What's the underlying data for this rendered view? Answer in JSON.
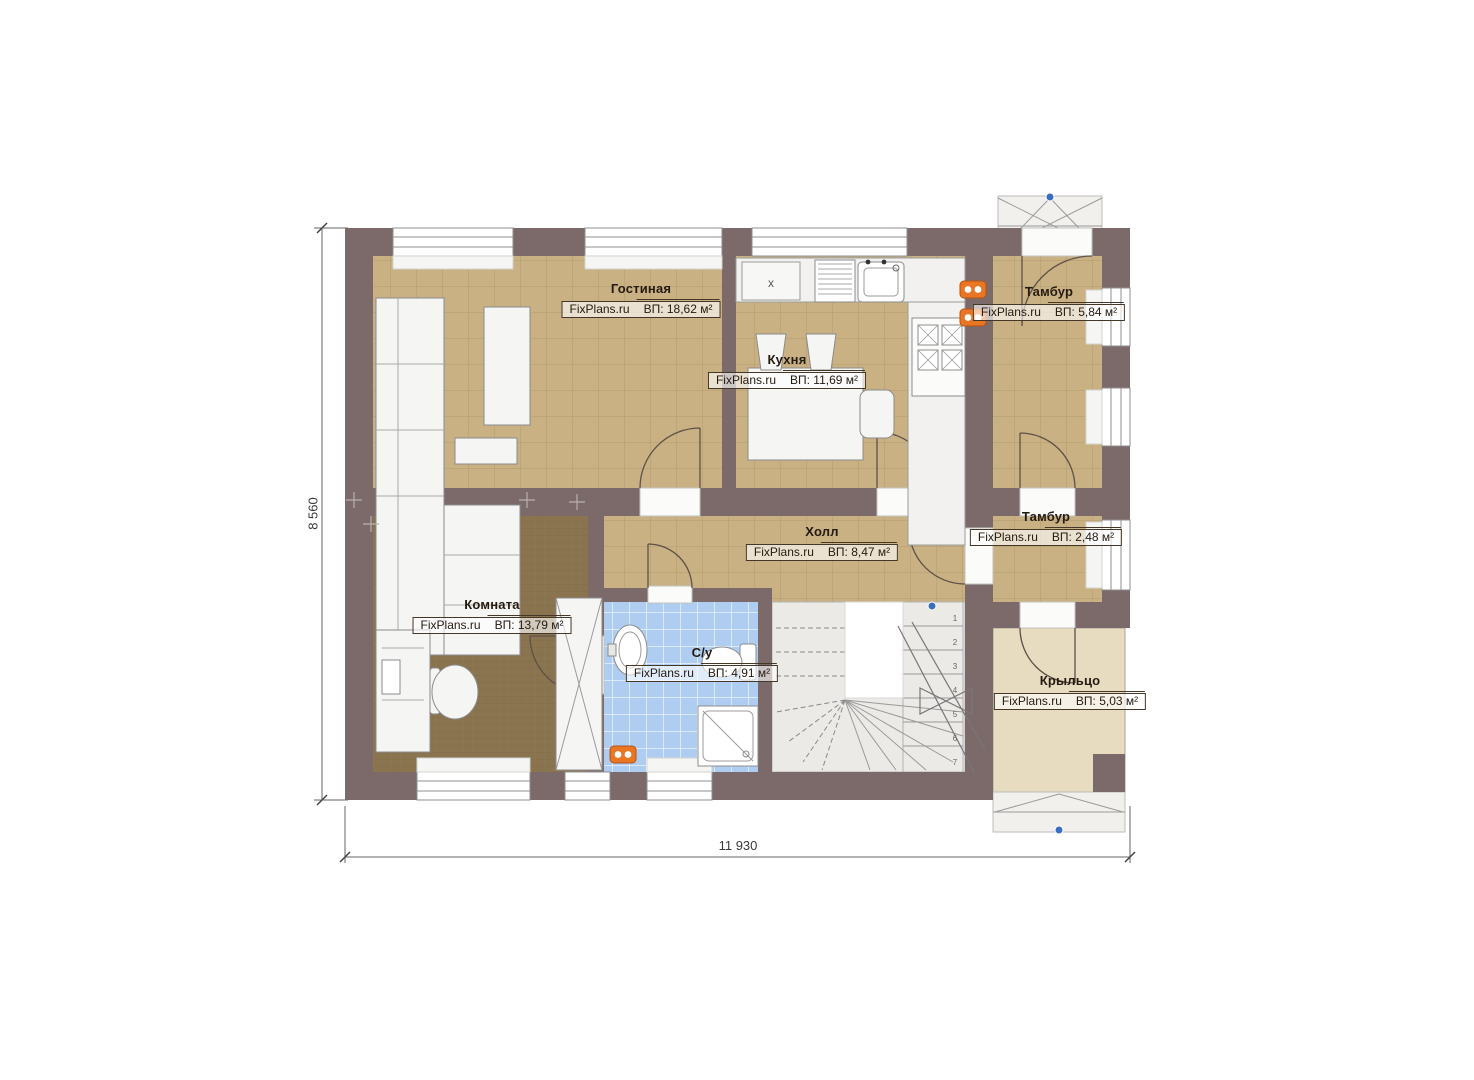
{
  "plan": {
    "watermark": "FixPlans.ru",
    "rooms": [
      {
        "name": "Гостиная",
        "area": "ВП: 18,62 м²"
      },
      {
        "name": "Кухня",
        "area": "ВП: 11,69 м²"
      },
      {
        "name": "Тамбур",
        "area": "ВП: 5,84 м²"
      },
      {
        "name": "Холл",
        "area": "ВП: 8,47 м²"
      },
      {
        "name": "Тамбур",
        "area": "ВП: 2,48 м²"
      },
      {
        "name": "Комната",
        "area": "ВП: 13,79 м²"
      },
      {
        "name": "С/у",
        "area": "ВП: 4,91 м²"
      },
      {
        "name": "Крыльцо",
        "area": "ВП: 5,03 м²"
      }
    ],
    "dimensions": {
      "height": "8 560",
      "width": "11 930"
    },
    "kitchen_mark": "x",
    "stairs": {
      "step_numbers": [
        "1",
        "2",
        "3",
        "4",
        "5",
        "6",
        "7"
      ]
    },
    "colors": {
      "wall": "#7c6a6b",
      "tile_floor": "#c9b184",
      "wood_floor": "#8a734f",
      "bath_floor": "#aecdf0",
      "porch_floor": "#e7dbc0",
      "radiator": "#e97623",
      "marker_blue": "#3a6fc0"
    }
  }
}
